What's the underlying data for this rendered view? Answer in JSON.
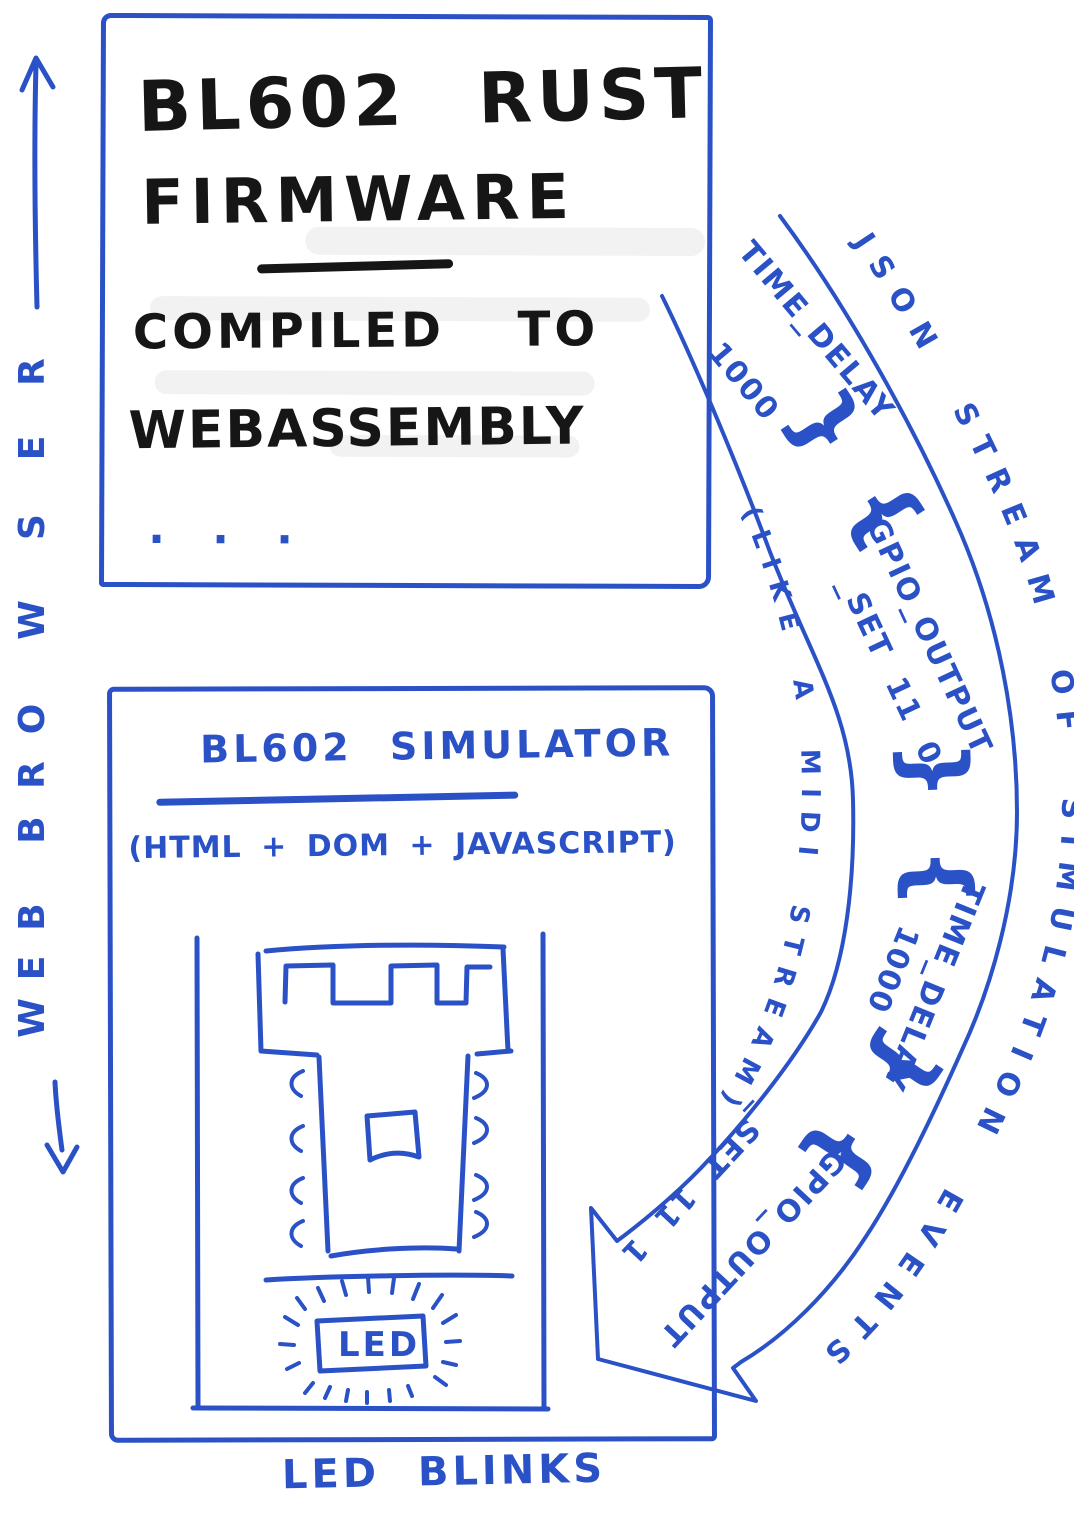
{
  "colors": {
    "ink_blue": "#2a52c6",
    "ink_black": "#161616",
    "paper": "#ffffff",
    "smudge": "#f2f2f2"
  },
  "browser_frame": {
    "label": "WEB BROWSER"
  },
  "firmware_box": {
    "title_line1": "BL602 RUST",
    "title_line2": "FIRMWARE",
    "body_line1": "COMPILED TO",
    "body_line2": "WEBASSEMBLY",
    "ellipsis": "· · ·"
  },
  "stream_arrow": {
    "outer_label": "JSON STREAM OF SIMULATION EVENTS",
    "inner_label": "(LIKE A MIDI STREAM)",
    "separator_glyph": "} {",
    "events": [
      {
        "name": "TIME_DELAY",
        "value": "1000"
      },
      {
        "name": "GPIO_OUTPUT",
        "value": "_SET  11  0"
      },
      {
        "name": "TIME_DELAY",
        "value": "1000"
      },
      {
        "name": "GPIO_OUTPUT",
        "value": "_SET  11  1"
      }
    ]
  },
  "simulator_box": {
    "title": "BL602 SIMULATOR",
    "subtitle": "(HTML + DOM + JAVASCRIPT)",
    "led_label": "LED",
    "caption": "LED BLINKS"
  }
}
